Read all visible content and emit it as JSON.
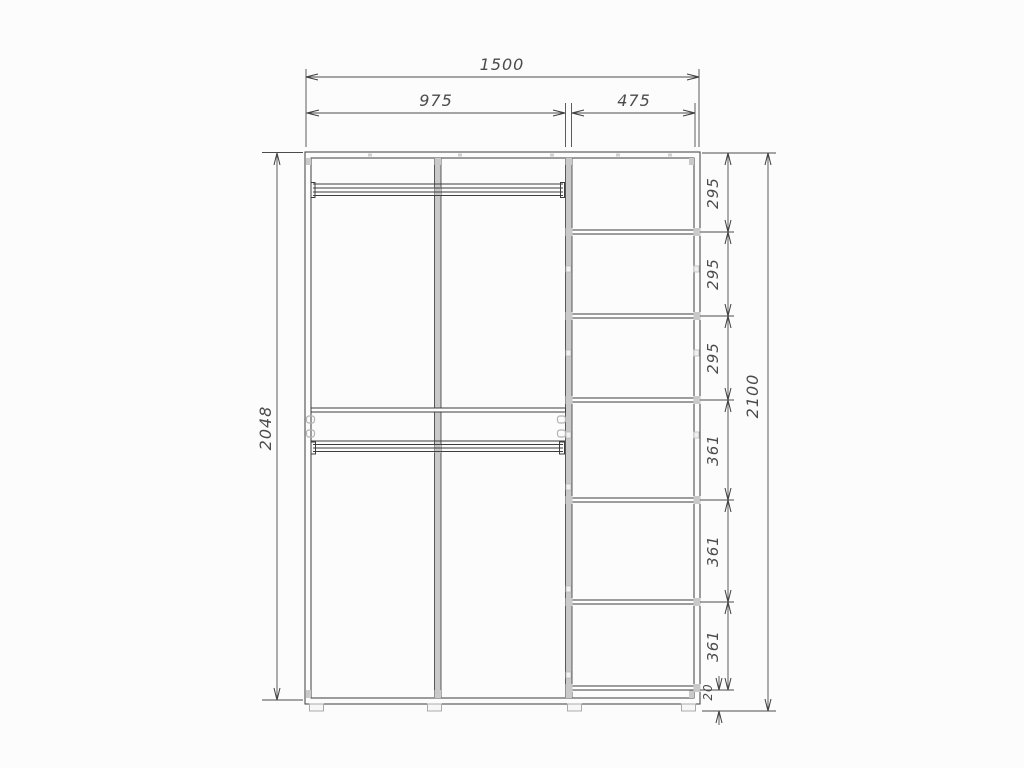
{
  "drawing": {
    "type": "furniture-technical-drawing",
    "subject": "wardrobe front elevation with dimensions",
    "dims": {
      "overall_width": "1500",
      "left_section_width": "975",
      "right_section_width": "475",
      "side_panel_height": "2048",
      "overall_height": "2100",
      "shelf_spacings": [
        "295",
        "295",
        "295",
        "361",
        "361",
        "361"
      ],
      "bottom_gap": "20"
    },
    "colors": {
      "background": "#fcfcfc",
      "line": "#3d3d3d",
      "dimension": "#4b4b4b",
      "panel_fill": "#c9c9c9",
      "fitting_fill": "#f0f0f0"
    }
  }
}
